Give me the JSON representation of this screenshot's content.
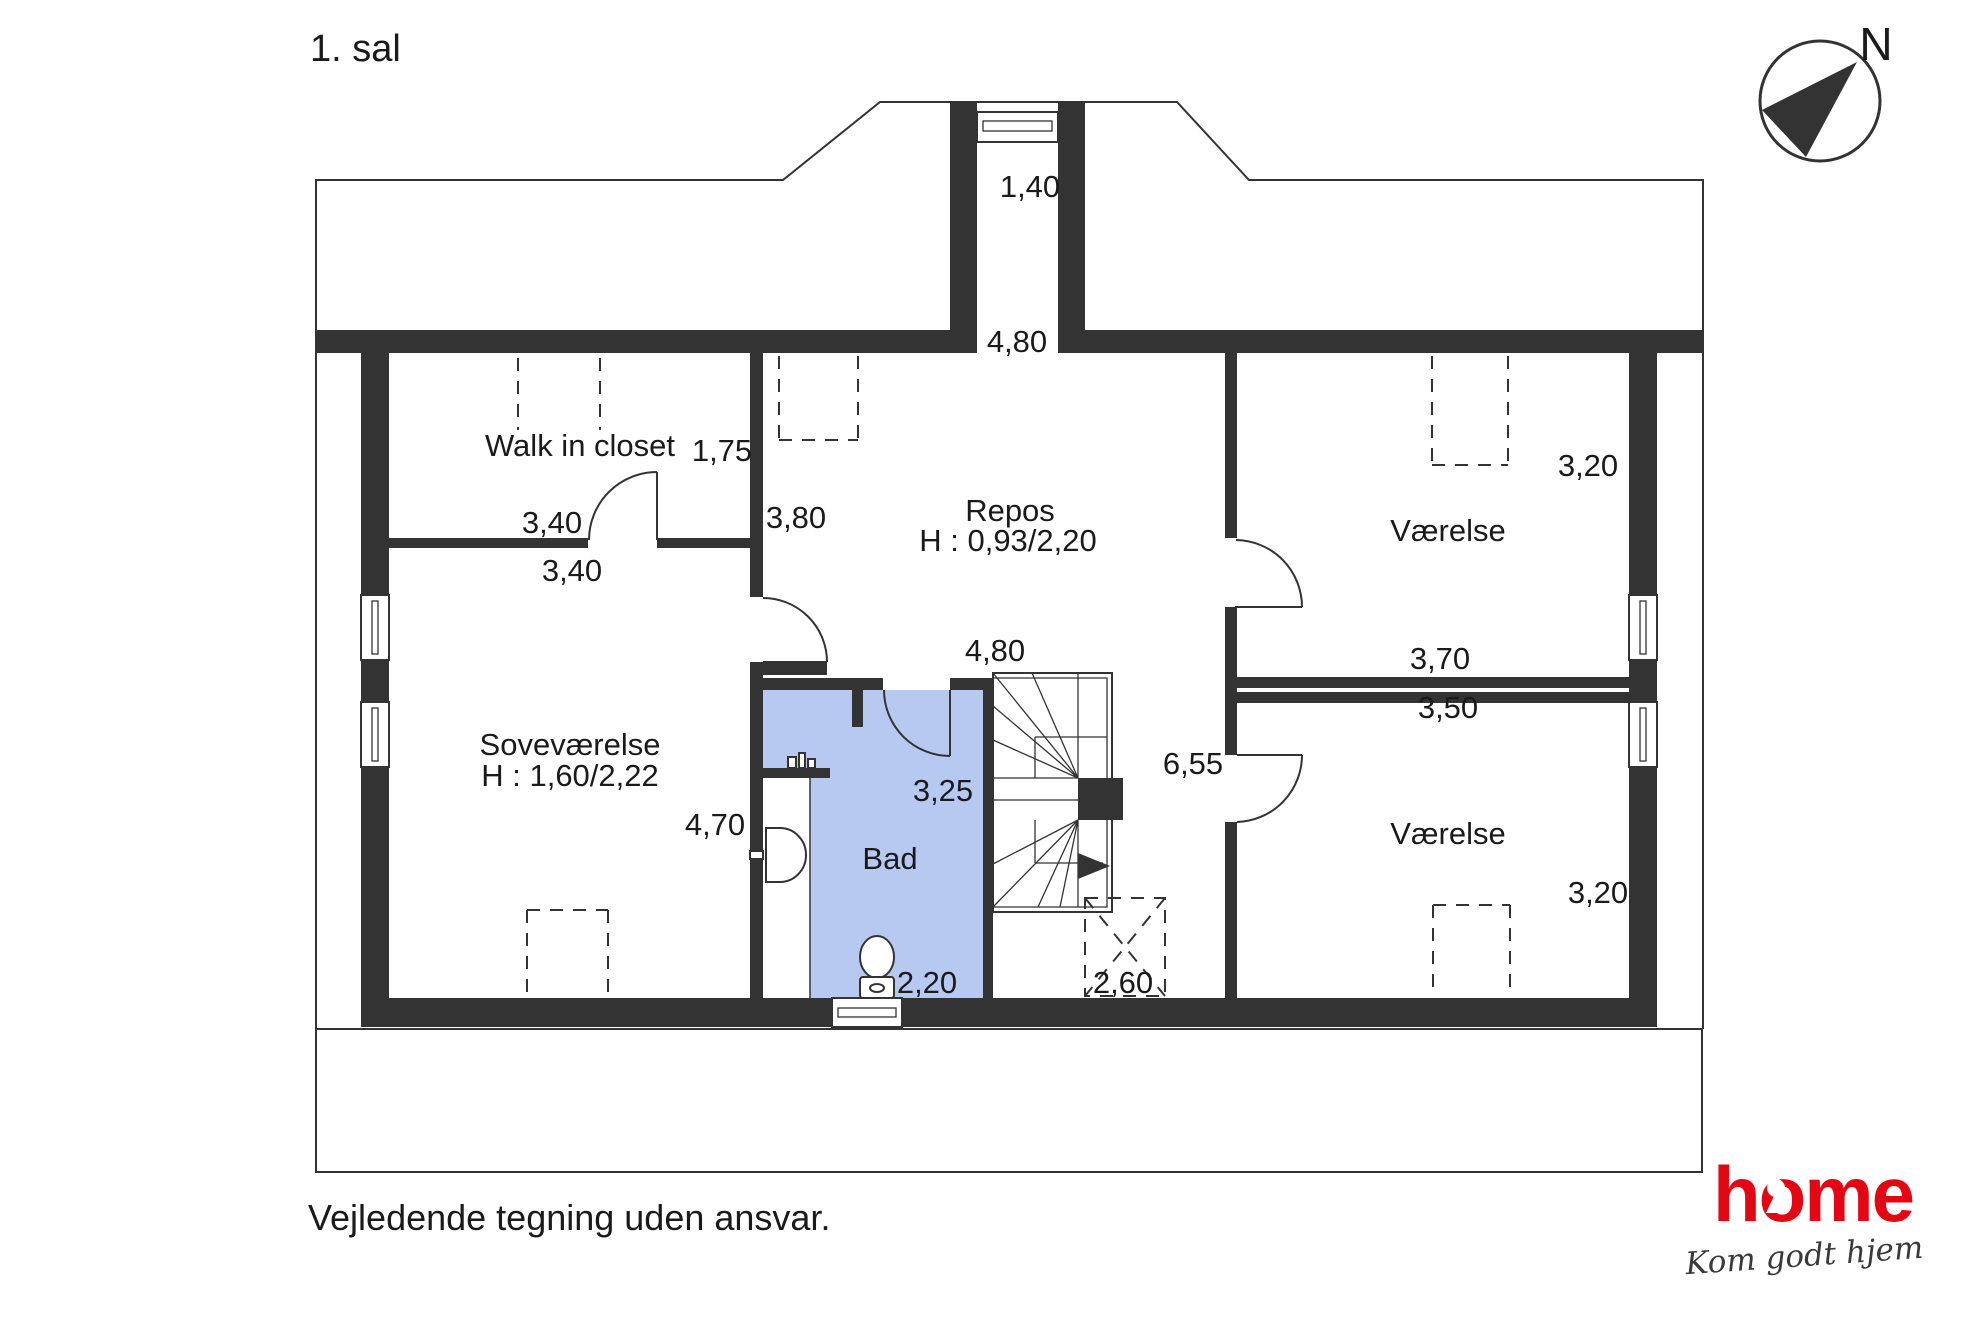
{
  "page_title": "1. sal",
  "compass_label": "N",
  "rooms": {
    "walk_in_closet": {
      "name": "Walk in closet"
    },
    "sovevaerelse": {
      "name": "Soveværelse",
      "height_note": "H : 1,60/2,22"
    },
    "repos": {
      "name": "Repos",
      "height_note": "H : 0,93/2,20"
    },
    "bad": {
      "name": "Bad"
    },
    "vaerelse_top": {
      "name": "Værelse"
    },
    "vaerelse_bottom": {
      "name": "Værelse"
    }
  },
  "dimensions": {
    "chimney_width": "1,40",
    "repos_top_width": "4,80",
    "closet_depth": "1,75",
    "closet_width_top": "3,40",
    "closet_width_bottom": "3,40",
    "repos_left_height": "3,80",
    "repos_mid_width": "4,80",
    "sove_height": "4,70",
    "bad_height": "3,25",
    "bad_width": "2,20",
    "stair_void": "2,60",
    "corridor_height": "6,55",
    "vaerelse_top_height": "3,20",
    "vaerelse_top_width": "3,70",
    "vaerelse_bottom_width": "3,50",
    "vaerelse_bottom_height": "3,20"
  },
  "footer_note": "Vejledende tegning uden ansvar.",
  "logo": {
    "brand": "home",
    "tagline": "Kom godt hjem"
  },
  "colors": {
    "wall": "#333333",
    "bath": "#b7c9f1",
    "brand_red": "#e30613",
    "ink": "#1a1a1a"
  }
}
